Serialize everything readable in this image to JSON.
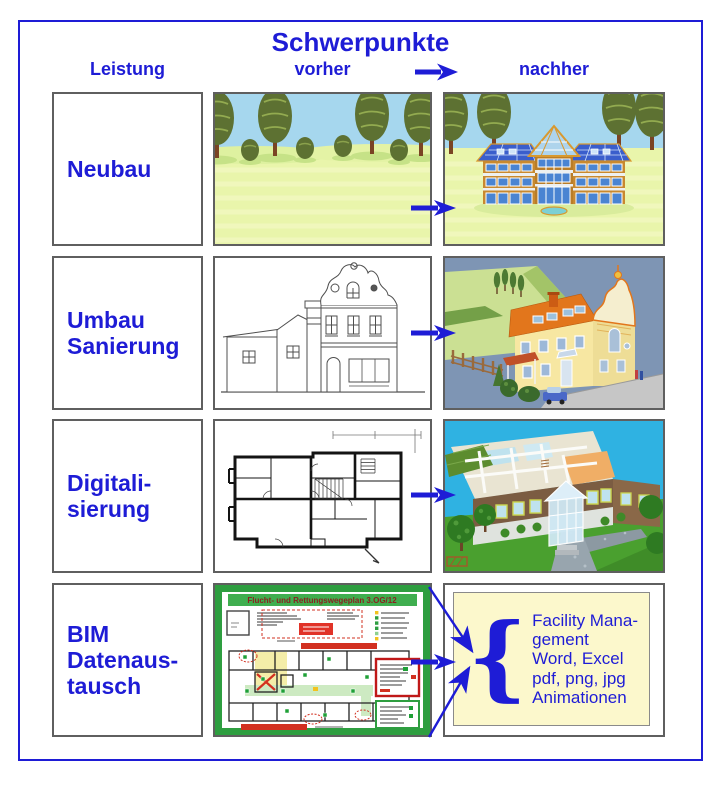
{
  "header": {
    "title": "Schwerpunkte",
    "col_leistung": "Leistung",
    "col_vorher": "vorher",
    "col_nachher": "nachher"
  },
  "rows": [
    {
      "label": "Neubau",
      "vorher_scene": "meadow-with-trees",
      "nachher_scene": "new-house-3d-rendering"
    },
    {
      "label": "Umbau\nSanierung",
      "vorher_scene": "old-house-line-drawing",
      "nachher_scene": "renovated-house-3d-rendering"
    },
    {
      "label": "Digitali-\nsierung",
      "vorher_scene": "scanned-2d-floor-plan",
      "nachher_scene": "digital-3d-building-model"
    },
    {
      "label": "BIM\nDatenaus-\ntausch",
      "vorher_scene": "escape-rescue-plan",
      "plan_title": "Flucht- und Rettungswegeplan  3.OG/12",
      "nachher_scene": "export-format-list",
      "brace": "{",
      "export_text": "Facility Mana-\ngement\nWord, Excel\npdf, png, jpg\nAnimationen"
    }
  ],
  "colors": {
    "accent_blue": "#1e1cd6",
    "box_border_gray": "#5f5f5f",
    "plan_green": "#2e9e40",
    "plan_red": "#d23020",
    "panel_yellow": "#fcf8cc"
  }
}
